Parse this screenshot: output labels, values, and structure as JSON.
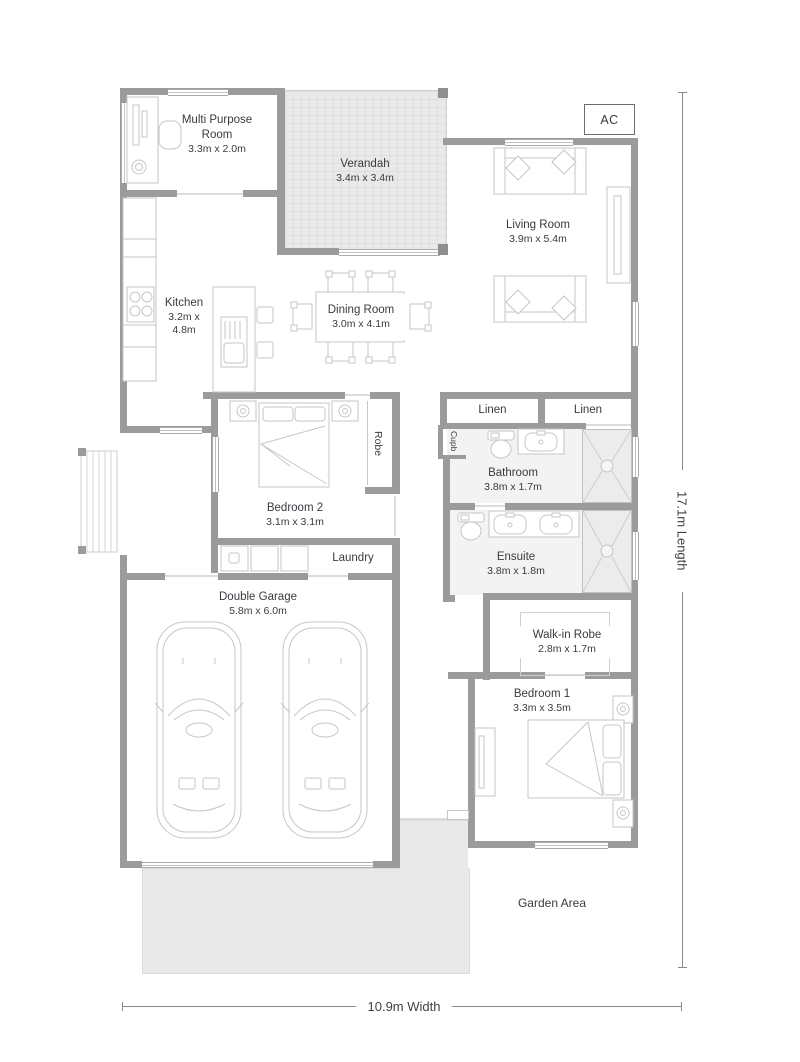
{
  "colors": {
    "wall": "#9b9b9b",
    "outdoor": "#e9e9e9",
    "wet": "#f3f3f3",
    "text": "#3a3a40",
    "line": "#8a8a8a",
    "furniture_line": "#c6c6c6"
  },
  "rooms": {
    "multi_purpose_room": {
      "label": "Multi Purpose Room",
      "dims": "3.3m x 2.0m"
    },
    "verandah": {
      "label": "Verandah",
      "dims": "3.4m x 3.4m"
    },
    "living_room": {
      "label": "Living Room",
      "dims": "3.9m x 5.4m"
    },
    "kitchen": {
      "label": "Kitchen",
      "dims": "3.2m x 4.8m"
    },
    "dining_room": {
      "label": "Dining Room",
      "dims": "3.0m x 4.1m"
    },
    "bedroom_2": {
      "label": "Bedroom 2",
      "dims": "3.1m x 3.1m"
    },
    "bathroom": {
      "label": "Bathroom",
      "dims": "3.8m x 1.7m"
    },
    "ensuite": {
      "label": "Ensuite",
      "dims": "3.8m x 1.8m"
    },
    "walk_in_robe": {
      "label": "Walk-in Robe",
      "dims": "2.8m x 1.7m"
    },
    "bedroom_1": {
      "label": "Bedroom 1",
      "dims": "3.3m x 3.5m"
    },
    "double_garage": {
      "label": "Double Garage",
      "dims": "5.8m x 6.0m"
    }
  },
  "closets": {
    "robe": "Robe",
    "linen_left": "Linen",
    "linen_right": "Linen",
    "cupboard": "Cupb",
    "laundry": "Laundry"
  },
  "annotations": {
    "ac_unit": "AC",
    "garden_area": "Garden Area"
  },
  "dimensions": {
    "width": "10.9m Width",
    "length": "17.1m Length"
  }
}
